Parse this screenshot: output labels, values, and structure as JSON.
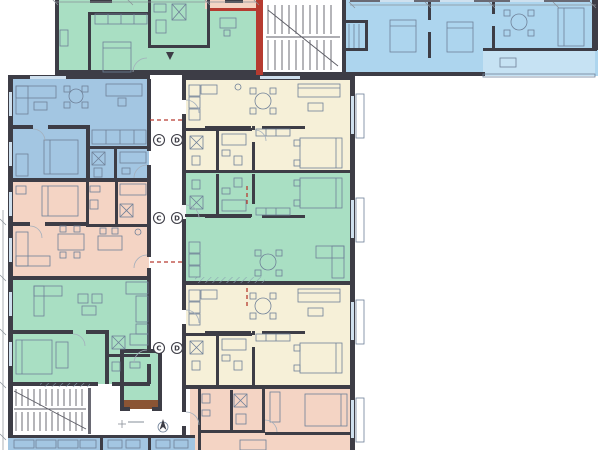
{
  "palette": {
    "green": "#a9dfc3",
    "green2": "#8fd3b2",
    "blue": "#a3c6e2",
    "bluewing": "#add5ee",
    "terrace": "#c6e2f3",
    "pink": "#f4d4c4",
    "cream": "#f6f0d8",
    "wood": "#8a5434",
    "wall": "#3d3d46",
    "wallmid": "#6a6a74",
    "window": "#cfe0ee",
    "furn": "#6f8098",
    "door": "#a3afbc",
    "stair": "#5b5b64",
    "dim": "#8a9098",
    "red": "#b63b30",
    "watermark": "#edeff1"
  },
  "axes": {
    "labels": [
      "C",
      "D"
    ]
  },
  "drawing": {
    "type": "architectural-floor-plan",
    "units": [
      {
        "id": "unit-top-left",
        "color_key": "green"
      },
      {
        "id": "unit-top-sliver",
        "color_key": "pink"
      },
      {
        "id": "unit-top-right-wing",
        "color_key": "bluewing"
      },
      {
        "id": "unit-left-upper",
        "color_key": "blue"
      },
      {
        "id": "unit-left-middle",
        "color_key": "pink"
      },
      {
        "id": "unit-left-lower",
        "color_key": "green"
      },
      {
        "id": "unit-right-upper",
        "color_key": "cream"
      },
      {
        "id": "unit-right-middle",
        "color_key": "green"
      },
      {
        "id": "unit-right-lower",
        "color_key": "cream"
      },
      {
        "id": "unit-bottom-right",
        "color_key": "pink"
      },
      {
        "id": "unit-bottom-strip",
        "color_key": "blue"
      }
    ],
    "features": [
      "corridor",
      "stairwell-top",
      "stairwell-bottom",
      "elevator",
      "expansion-joint",
      "terrace",
      "axis-markers",
      "north-arrow"
    ]
  }
}
